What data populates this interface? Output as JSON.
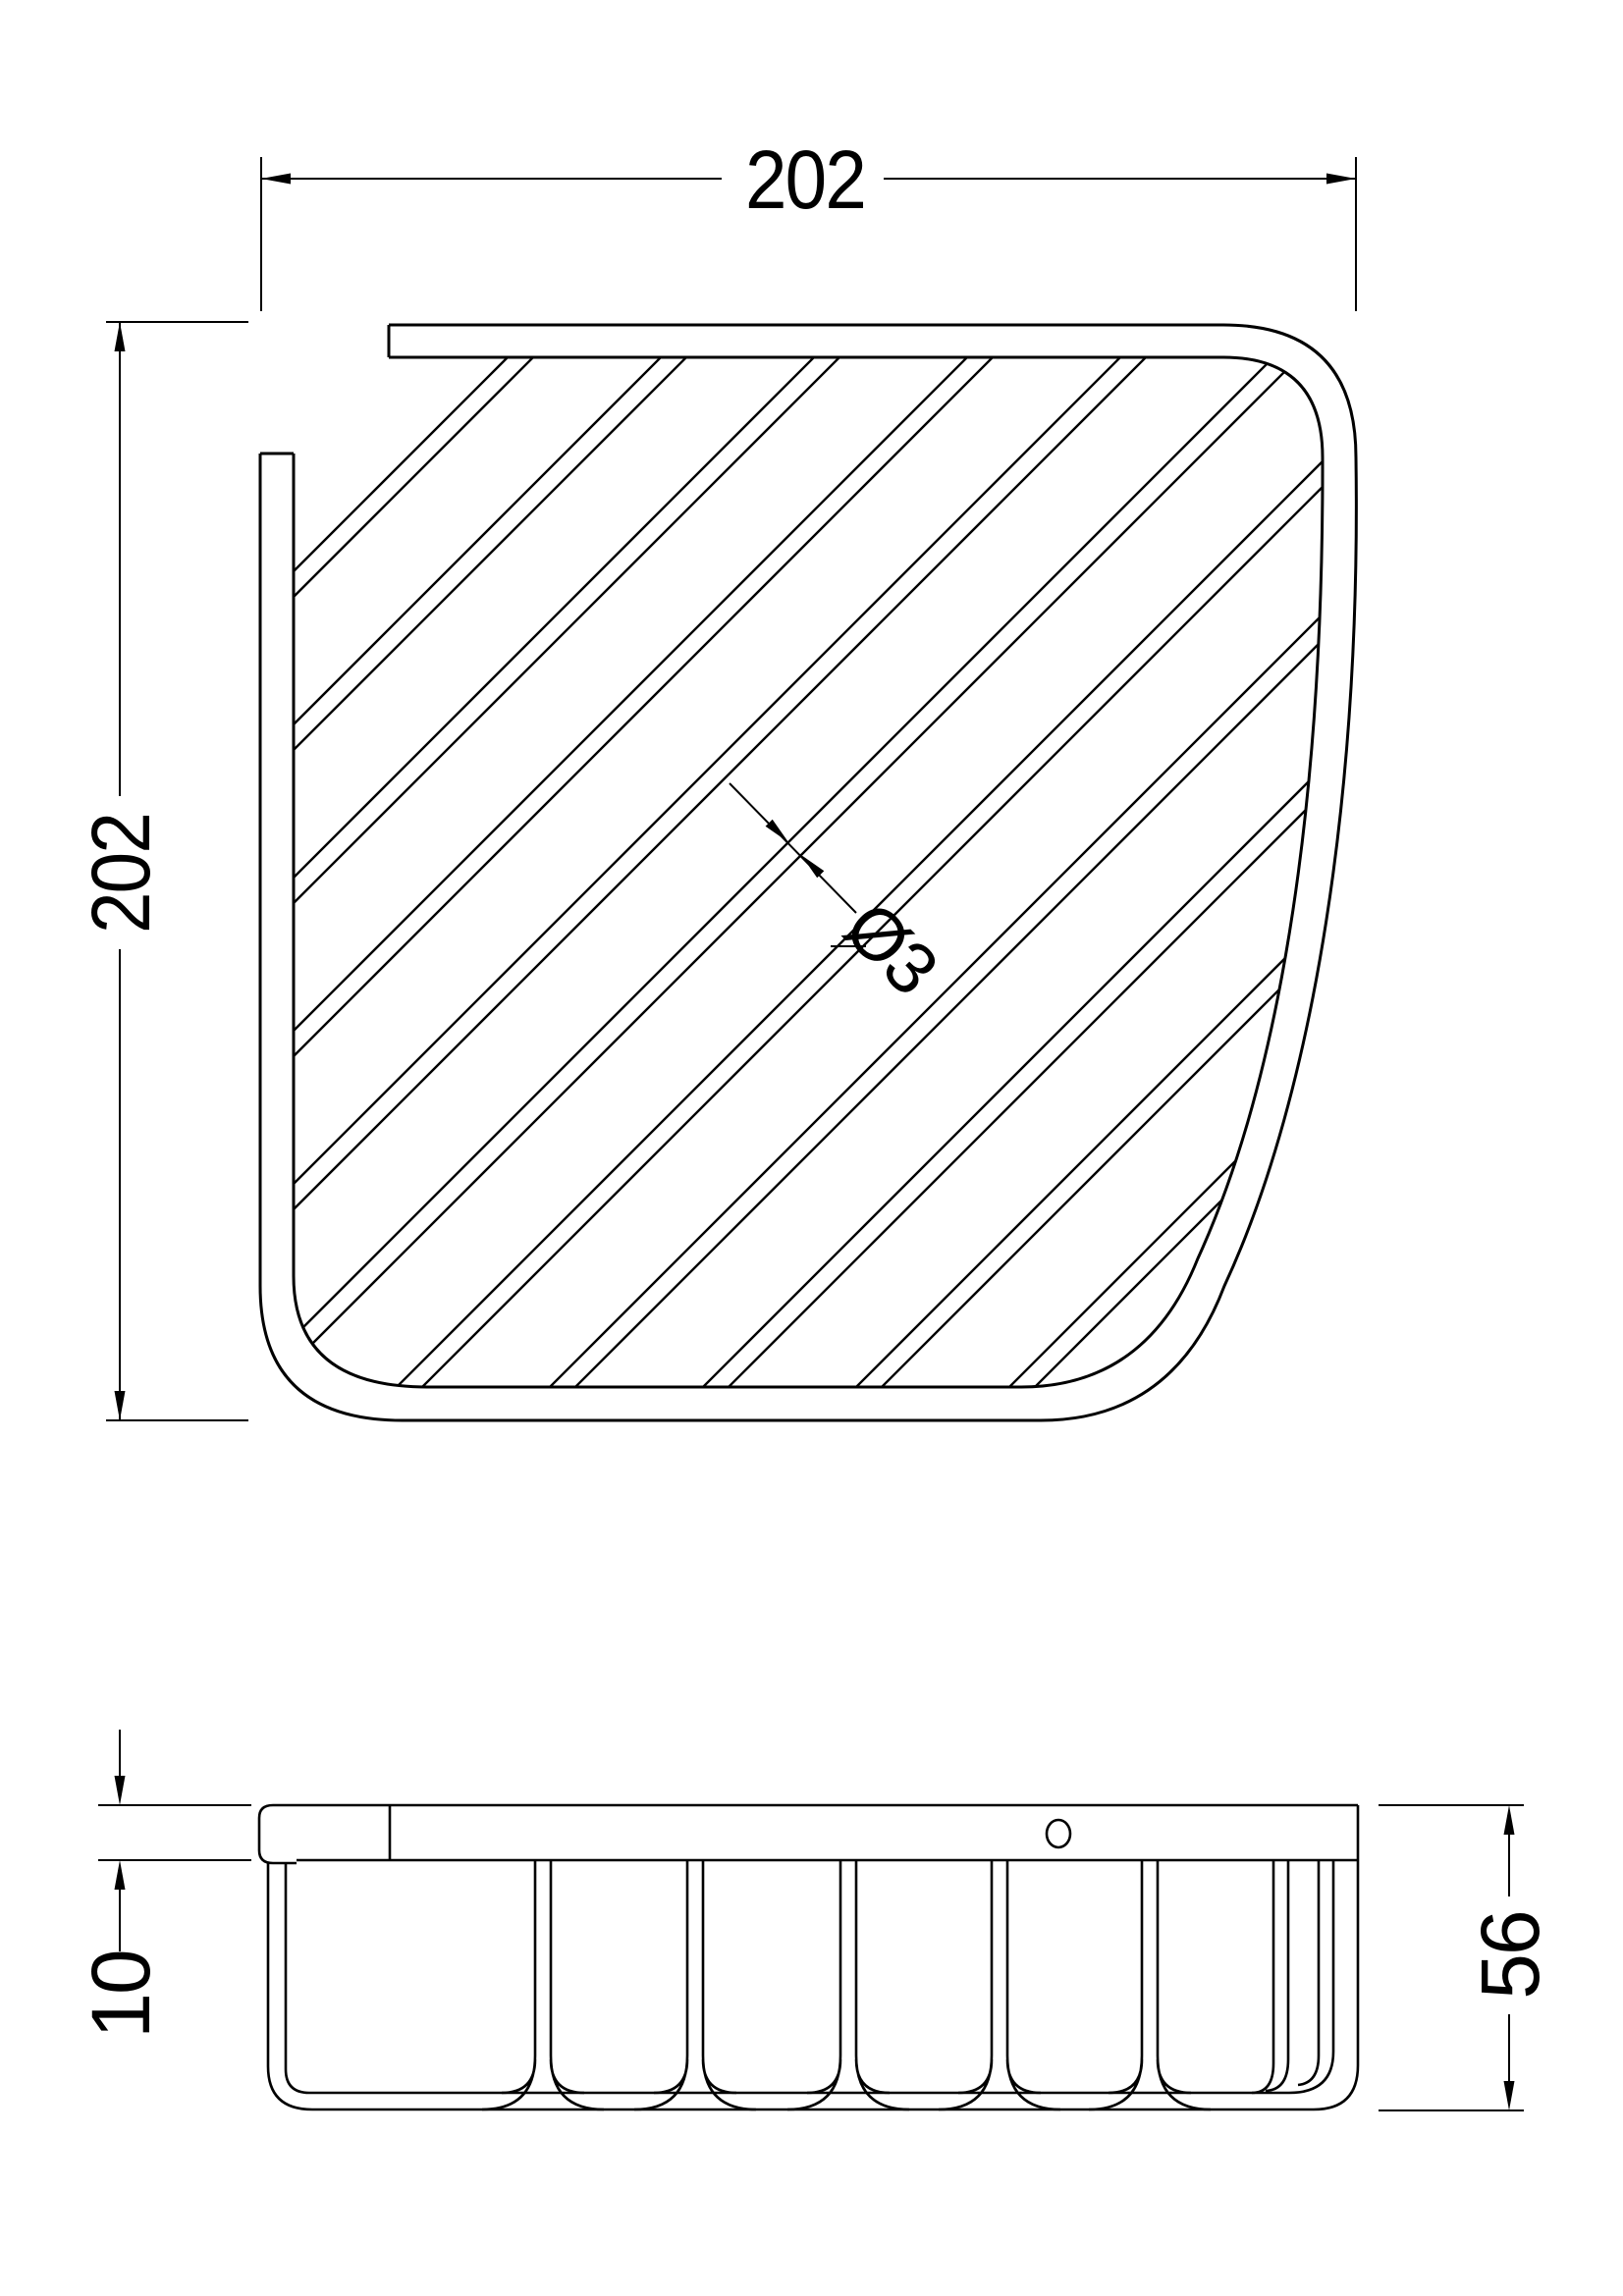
{
  "colors": {
    "line": "#000000",
    "background": "#ffffff"
  },
  "top_view": {
    "width_dim_label": "202",
    "height_dim_label": "202",
    "wire_diameter_label": "Ø3"
  },
  "side_view": {
    "rail_thickness_dim_label": "10",
    "overall_height_dim_label": "56"
  }
}
